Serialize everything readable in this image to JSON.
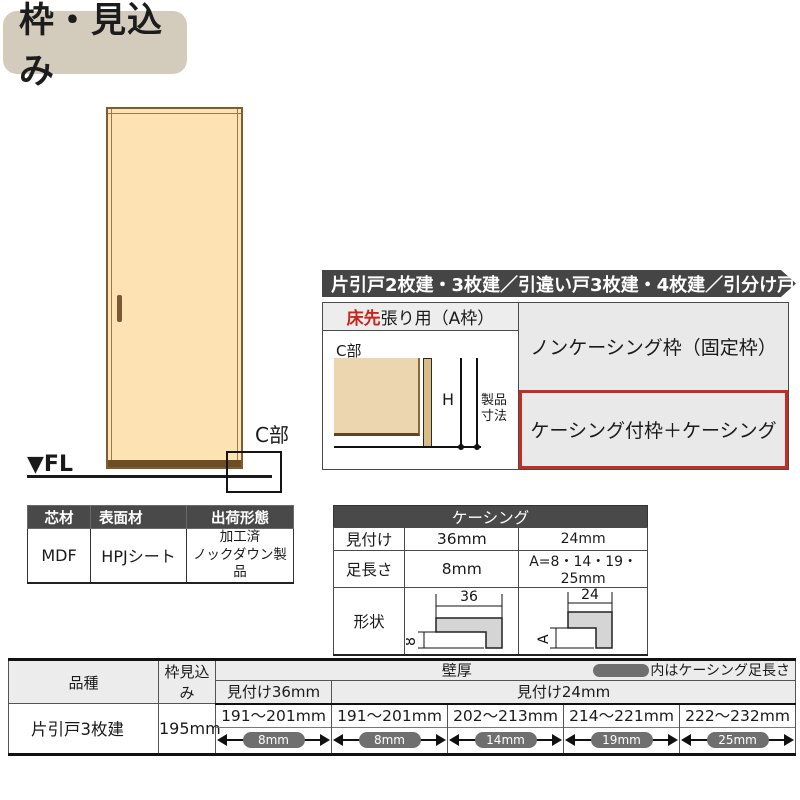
{
  "title": "枠・見込み",
  "door": {
    "fl_label": "▼FL",
    "c_part_label": "C部"
  },
  "material_table": {
    "h_core": "芯材",
    "h_surface": "表面材",
    "h_ship": "出荷形態",
    "core": "MDF",
    "surface": "HPJシート",
    "ship_line1": "加工済",
    "ship_line2": "ノックダウン製品"
  },
  "panel": {
    "header": "片引戸2枚建・3枚建／引違い戸3枚建・4枚建／引分け戸",
    "floor_red": "床先",
    "floor_rest": "張り用（A枠）",
    "c_part_label": "C部",
    "dim_h": "H",
    "dim_product_l1": "製品",
    "dim_product_l2": "寸法",
    "option_noncasing": "ノンケーシング枠（固定枠）",
    "option_casing": "ケーシング付枠＋ケーシング"
  },
  "casing": {
    "title": "ケーシング",
    "r1_label": "見付け",
    "r1_c1": "36mm",
    "r1_c2": "24mm",
    "r2_label": "足長さ",
    "r2_c1": "8mm",
    "r2_c2": "A=8・14・19・25mm",
    "r3_label": "形状",
    "shape36": {
      "w": "36",
      "h": "8"
    },
    "shape24": {
      "w": "24",
      "h": "A"
    }
  },
  "spec": {
    "h_type": "品種",
    "h_depth": "枠見込み",
    "h_wall": "壁厚",
    "wall_note": "内はケーシング足長さ",
    "h_m36": "見付け36mm",
    "h_m24": "見付け24mm",
    "type": "片引戸3枚建",
    "depth": "195mm",
    "cells": [
      {
        "range": "191～201mm",
        "leg": "8mm"
      },
      {
        "range": "191～201mm",
        "leg": "8mm"
      },
      {
        "range": "202～213mm",
        "leg": "14mm"
      },
      {
        "range": "214～221mm",
        "leg": "19mm"
      },
      {
        "range": "222～232mm",
        "leg": "25mm"
      }
    ]
  },
  "colors": {
    "accent_red": "#c62c22",
    "header_dark": "#494949",
    "pill_gray": "#6f6f6f"
  }
}
